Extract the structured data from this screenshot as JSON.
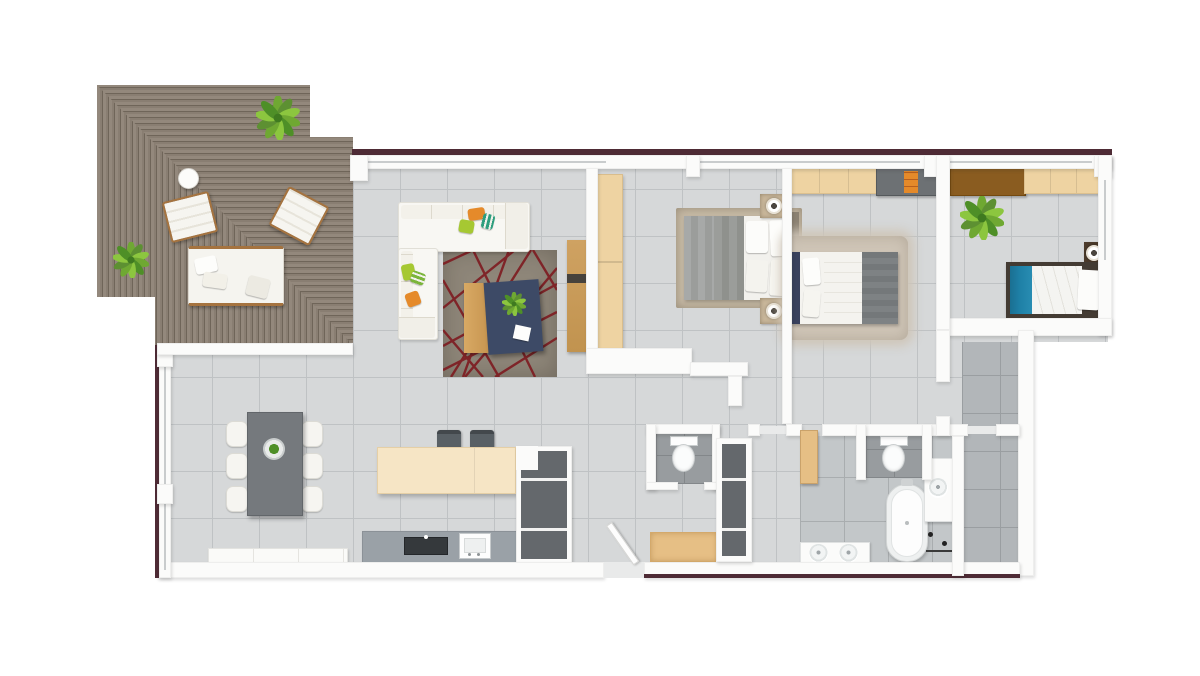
{
  "meta": {
    "type": "3d-rendered-floor-plan",
    "view": "top-down",
    "visible_text": "none"
  },
  "palette": {
    "wall": "#fbfbfa",
    "outerLine": "#4e2b35",
    "floorLight": "#d6d8d9",
    "floorMid": "#c3c7c9",
    "floorDark": "#989c9f",
    "floorLaundry": "#b2b6b9",
    "grout": "#bfc2c4",
    "deckA": "#93887c",
    "deckB": "#897e72",
    "deckGap": "#6f6559",
    "woodLight": "#eed3a2",
    "woodMid": "#d8a964",
    "woodTan": "#e6bf85",
    "brown": "#8a5c20",
    "navy": "#3d4a66",
    "tealBed": "#1e80a6",
    "rugTaupe": "#8e8679",
    "rugRed": "#7e1d22",
    "shagRug": "#cfc5b7",
    "grayTable": "#75797d",
    "darkCabinet": "#64686c",
    "counter": "#9aa1a7",
    "cooktop": "#35393c",
    "stool": "#596065",
    "sofa": "#f7f6f2",
    "orange": "#e58a2a",
    "lime": "#a6c832",
    "greenLeaf": "#6fa832"
  },
  "rooms": [
    {
      "name": "terrace-deck",
      "floor": "diagonal wood planks",
      "furniture": [
        "potted-plant-large",
        "potted-plant-small",
        "round-side-table",
        "lounge-chair",
        "lounge-chair",
        "daybed"
      ]
    },
    {
      "name": "living-room",
      "floor": "light gray tile",
      "furniture": [
        "corner-sofa-white",
        "throw-pillows-orange-lime-teal",
        "area-rug-taupe-red-lines",
        "coffee-table-wood-navy",
        "table-plant",
        "tv-sideboard-wood"
      ]
    },
    {
      "name": "dining-area",
      "floor": "light gray tile",
      "furniture": [
        "dining-table-gray",
        "dining-chairs-x6",
        "centerpiece-plant",
        "white-sideboard"
      ]
    },
    {
      "name": "kitchen",
      "floor": "light gray tile",
      "furniture": [
        "island-cream",
        "bar-stools-x2",
        "counter-gray",
        "cooktop",
        "sink",
        "tall-cabinet-column"
      ]
    },
    {
      "name": "bedroom-master",
      "floor": "light gray tile",
      "furniture": [
        "double-bed-gray-white",
        "nightstand-x2",
        "table-lamp-x2",
        "wardrobe-light-wood",
        "bed-rug"
      ]
    },
    {
      "name": "bedroom-second",
      "floor": "light gray tile",
      "furniture": [
        "double-bed-navy-frame",
        "closet-light-wood",
        "dresser-gray-orange",
        "shag-rug"
      ]
    },
    {
      "name": "kids-room",
      "floor": "light gray tile",
      "furniture": [
        "single-bed-teal-blanket",
        "nightstand-lamp",
        "desk-brown",
        "closet-light-wood",
        "potted-plant"
      ]
    },
    {
      "name": "wc",
      "floor": "dark gray tile",
      "furniture": [
        "toilet"
      ]
    },
    {
      "name": "bathroom",
      "floor": "gray tile",
      "furniture": [
        "toilet-niche",
        "freestanding-bathtub",
        "vanity-single-basin",
        "double-basin-vanity",
        "towel-fixtures",
        "open-door-wood"
      ]
    },
    {
      "name": "laundry-nook",
      "floor": "medium gray tile",
      "furniture": []
    },
    {
      "name": "hallway",
      "floor": "light gray tile",
      "furniture": [
        "storage-column-dark",
        "bench-tan",
        "entry-door-open"
      ]
    }
  ]
}
